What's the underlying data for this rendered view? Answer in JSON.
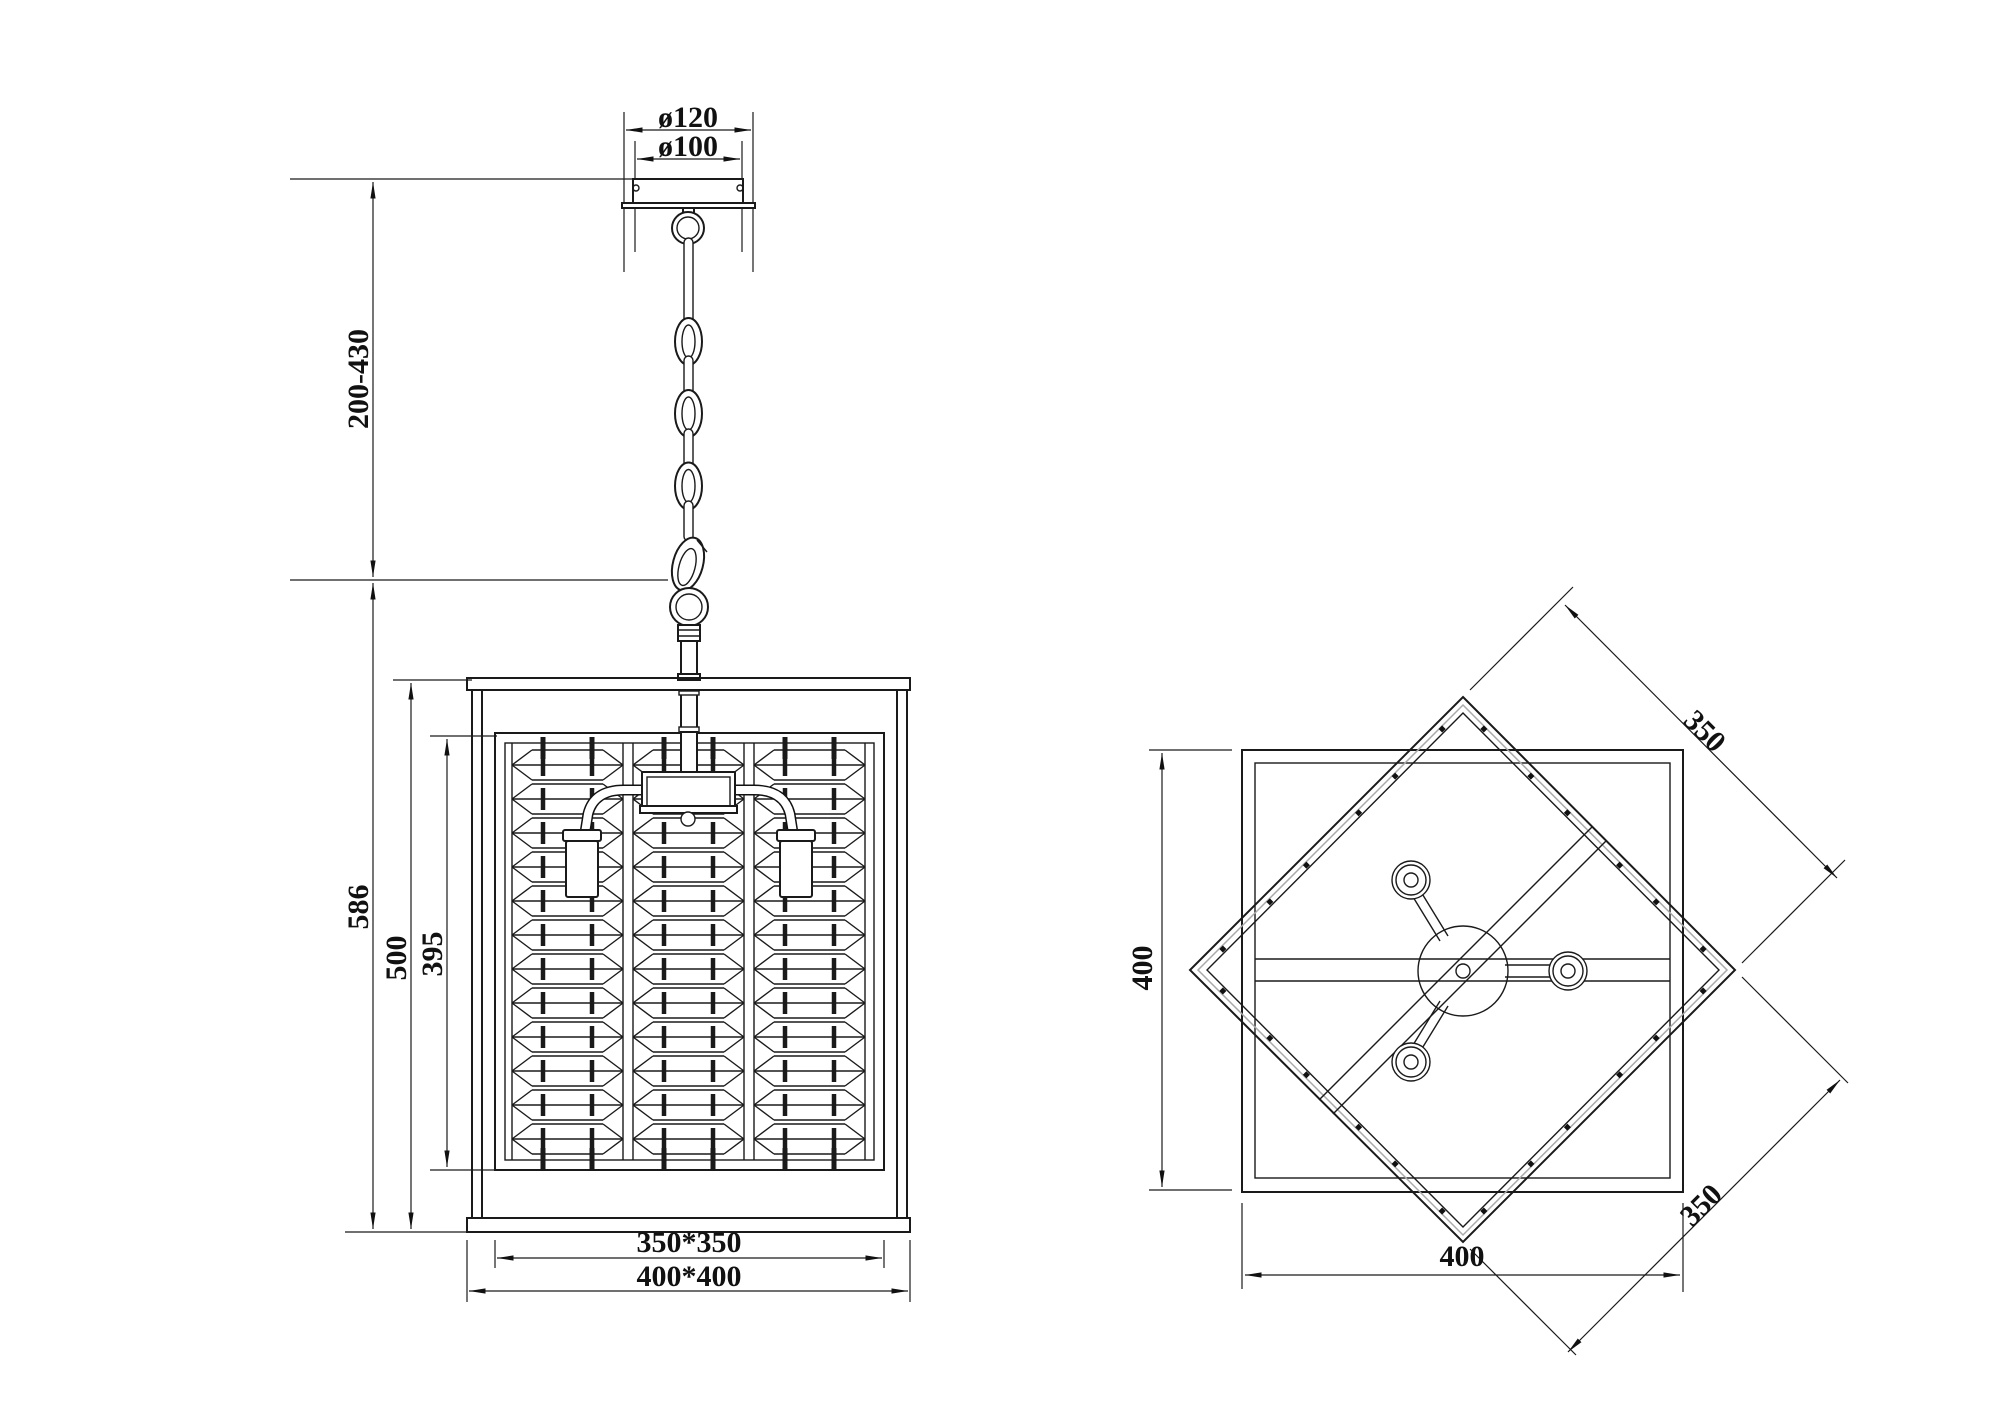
{
  "front_view": {
    "canopy_outer_dia": "ø120",
    "canopy_inner_dia": "ø100",
    "suspension_height": "200-430",
    "overall_height": "586",
    "frame_height": "500",
    "shade_height": "395",
    "shade_footprint": "350*350",
    "frame_footprint": "400*400"
  },
  "plan_view": {
    "frame_side_vertical": "400",
    "frame_side_horizontal": "400",
    "shade_side_upper": "350",
    "shade_side_lower": "350"
  }
}
